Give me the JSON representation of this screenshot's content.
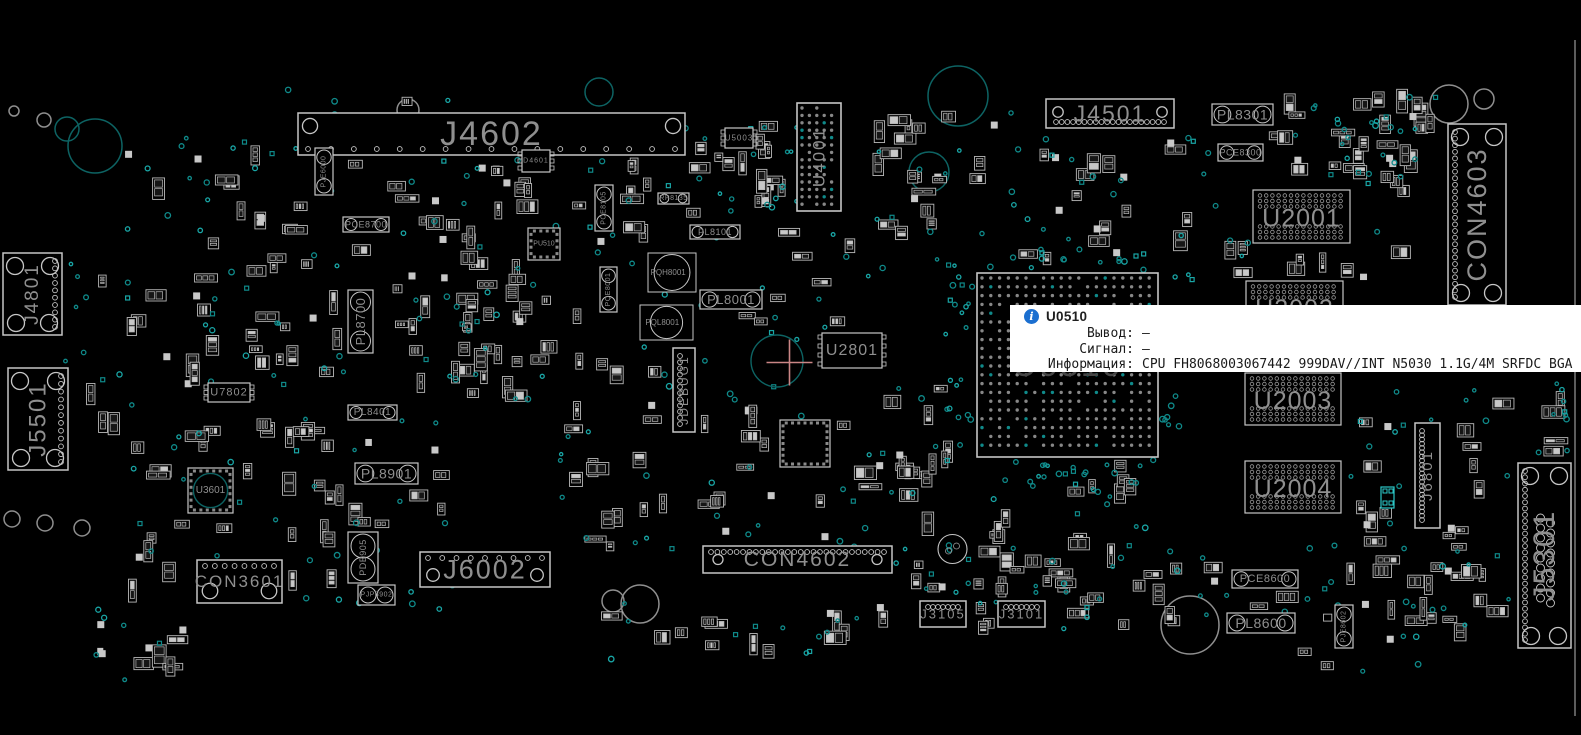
{
  "app": {
    "name": "boardview",
    "view": "top"
  },
  "tooltip": {
    "title": "U0510",
    "icon": "info-icon",
    "accent_color": "#1b6fd0",
    "rows": [
      {
        "label": "Вывод:",
        "value": "—"
      },
      {
        "label": "Сигнал:",
        "value": "—"
      },
      {
        "label": "Информация:",
        "value": "CPU FH8068003067442 999DAV//INT N5030 1.1G/4M SRFDC BGA"
      }
    ]
  },
  "board": {
    "colors": {
      "background": "#000000",
      "outline": "#c6c6c6",
      "outline_dim": "#9a9a9a",
      "label": "#8f8f8f",
      "label_dim": "#454545",
      "pad_dark": "#161616",
      "pad_bright": "#c8c8c8",
      "via": "#0f8a8a",
      "via_bright": "#19a6a6",
      "hole_teal": "#0d6363",
      "hole_gray": "#8f8f8f",
      "highlight": "#2cc8c8",
      "crosshair": "#ca8585",
      "edge": "#9a9a9a"
    },
    "components": [
      {
        "label": "J4602",
        "x": 298,
        "y": 113,
        "w": 387,
        "h": 42,
        "type": "con",
        "fs": 34,
        "orient": "h",
        "pins": "bottom:17",
        "corners": "tl,tr"
      },
      {
        "label": "J4501",
        "x": 1046,
        "y": 99,
        "w": 128,
        "h": 29,
        "type": "con",
        "fs": 23,
        "orient": "h",
        "pins": "bottom:20",
        "corners": "tl,tr"
      },
      {
        "label": "CON4603",
        "x": 1448,
        "y": 124,
        "w": 58,
        "h": 181,
        "type": "con",
        "fs": 27,
        "orient": "v",
        "pins": "left:26",
        "corners": "all"
      },
      {
        "label": "U4001",
        "x": 797,
        "y": 103,
        "w": 44,
        "h": 108,
        "type": "bga",
        "fs": 17,
        "orient": "v",
        "grid": 7.4
      },
      {
        "label": "U2001",
        "x": 1253,
        "y": 190,
        "w": 97,
        "h": 53,
        "type": "mem",
        "fs": 25,
        "orient": "h"
      },
      {
        "label": "U2002",
        "x": 1246,
        "y": 281,
        "w": 97,
        "h": 52,
        "type": "mem",
        "fs": 25,
        "orient": "h"
      },
      {
        "label": "U2003",
        "x": 1245,
        "y": 373,
        "w": 96,
        "h": 52,
        "type": "mem",
        "fs": 25,
        "orient": "h"
      },
      {
        "label": "U2004",
        "x": 1245,
        "y": 461,
        "w": 96,
        "h": 52,
        "type": "mem",
        "fs": 25,
        "orient": "h"
      },
      {
        "label": "U0510",
        "x": 977,
        "y": 273,
        "w": 181,
        "h": 184,
        "type": "bga",
        "fs": 34,
        "orient": "h",
        "grid": 8.8,
        "dim": true
      },
      {
        "label": "J6801",
        "x": 1415,
        "y": 423,
        "w": 25,
        "h": 105,
        "type": "con",
        "fs": 15,
        "orient": "v",
        "pins": "left:22",
        "corners": "none"
      },
      {
        "label": "J5301",
        "x": 1518,
        "y": 463,
        "w": 53,
        "h": 185,
        "type": "con",
        "fs": 30,
        "orient": "v",
        "pins": "left:28",
        "corners": "all",
        "extra": "midcircles"
      },
      {
        "label": "J4801",
        "x": 3,
        "y": 253,
        "w": 59,
        "h": 82,
        "type": "con",
        "fs": 19,
        "orient": "v",
        "pins": "right:10",
        "corners": "all"
      },
      {
        "label": "J5501",
        "x": 8,
        "y": 368,
        "w": 60,
        "h": 102,
        "type": "con",
        "fs": 24,
        "orient": "v",
        "pins": "right:12",
        "corners": "all"
      },
      {
        "label": "CON3601",
        "x": 197,
        "y": 560,
        "w": 85,
        "h": 43,
        "type": "con",
        "fs": 17,
        "orient": "h",
        "pins": "top:8",
        "corners": "bl,br"
      },
      {
        "label": "J6002",
        "x": 420,
        "y": 552,
        "w": 130,
        "h": 35,
        "type": "con",
        "fs": 27,
        "orient": "h",
        "pins": "top:9",
        "corners": "bl,br"
      },
      {
        "label": "CON4602",
        "x": 703,
        "y": 546,
        "w": 189,
        "h": 27,
        "type": "con",
        "fs": 21,
        "orient": "h",
        "pins": "top:28",
        "corners": "lr"
      },
      {
        "label": "J3105",
        "x": 920,
        "y": 601,
        "w": 46,
        "h": 26,
        "type": "con",
        "fs": 13,
        "orient": "h",
        "pins": "top:7",
        "corners": "none"
      },
      {
        "label": "J3101",
        "x": 998,
        "y": 601,
        "w": 47,
        "h": 26,
        "type": "con",
        "fs": 13,
        "orient": "h",
        "pins": "top:7",
        "corners": "none"
      },
      {
        "label": "JDEBUG1",
        "x": 673,
        "y": 348,
        "w": 22,
        "h": 84,
        "type": "con",
        "fs": 12,
        "orient": "v",
        "pins": "left:12",
        "corners": "none"
      },
      {
        "label": "U2801",
        "x": 822,
        "y": 333,
        "w": 60,
        "h": 35,
        "type": "chip",
        "fs": 16,
        "pins": "lr:4"
      },
      {
        "label": "U3601",
        "x": 188,
        "y": 468,
        "w": 45,
        "h": 45,
        "type": "qfn",
        "fs": 10,
        "circle": true
      },
      {
        "label": "U7802",
        "x": 208,
        "y": 383,
        "w": 42,
        "h": 19,
        "type": "chip",
        "fs": 11,
        "pins": "lr:3"
      },
      {
        "label": "U5003",
        "x": 725,
        "y": 128,
        "w": 28,
        "h": 20,
        "type": "chip",
        "fs": 8,
        "pins": "lr:3"
      },
      {
        "label": "D4601",
        "x": 522,
        "y": 150,
        "w": 28,
        "h": 22,
        "type": "chip",
        "fs": 7,
        "pins": "lr:3"
      },
      {
        "label": "PU510",
        "x": 528,
        "y": 228,
        "w": 32,
        "h": 32,
        "type": "qfn",
        "fs": 7
      },
      {
        "label": "",
        "x": 780,
        "y": 420,
        "w": 50,
        "h": 47,
        "type": "qfn",
        "fs": 0
      },
      {
        "label": "PL8301",
        "x": 1212,
        "y": 104,
        "w": 61,
        "h": 21,
        "type": "pill",
        "fs": 14
      },
      {
        "label": "PCE8300",
        "x": 1218,
        "y": 144,
        "w": 45,
        "h": 17,
        "type": "pill",
        "fs": 9
      },
      {
        "label": "PL8901",
        "x": 355,
        "y": 463,
        "w": 63,
        "h": 21,
        "type": "pill",
        "fs": 14
      },
      {
        "label": "PL8600",
        "x": 1227,
        "y": 613,
        "w": 68,
        "h": 20,
        "type": "pill",
        "fs": 14
      },
      {
        "label": "PCE8600",
        "x": 1232,
        "y": 570,
        "w": 66,
        "h": 18,
        "type": "pill",
        "fs": 11
      },
      {
        "label": "PL8001",
        "x": 700,
        "y": 290,
        "w": 62,
        "h": 19,
        "type": "pill",
        "fs": 13
      },
      {
        "label": "PL8101",
        "x": 690,
        "y": 225,
        "w": 50,
        "h": 14,
        "type": "pill",
        "fs": 9
      },
      {
        "label": "PL8401",
        "x": 348,
        "y": 405,
        "w": 49,
        "h": 15,
        "type": "pill",
        "fs": 10
      },
      {
        "label": "PCE8700",
        "x": 343,
        "y": 217,
        "w": 46,
        "h": 15,
        "type": "pill",
        "fs": 9
      },
      {
        "label": "PL8700",
        "x": 348,
        "y": 290,
        "w": 25,
        "h": 63,
        "type": "pill",
        "fs": 13,
        "orient": "v"
      },
      {
        "label": "PCE8105",
        "x": 595,
        "y": 185,
        "w": 18,
        "h": 46,
        "type": "pill",
        "fs": 7,
        "orient": "v"
      },
      {
        "label": "PJE6000",
        "x": 315,
        "y": 148,
        "w": 18,
        "h": 47,
        "type": "pill",
        "fs": 7,
        "orient": "v"
      },
      {
        "label": "PQE8001",
        "x": 600,
        "y": 267,
        "w": 17,
        "h": 45,
        "type": "pill",
        "fs": 7,
        "orient": "v"
      },
      {
        "label": "PDB905",
        "x": 348,
        "y": 532,
        "w": 30,
        "h": 51,
        "type": "pill",
        "fs": 9,
        "orient": "v"
      },
      {
        "label": "PJE8602",
        "x": 1335,
        "y": 605,
        "w": 18,
        "h": 43,
        "type": "pill",
        "fs": 7,
        "orient": "v"
      },
      {
        "label": "PJP8902",
        "x": 358,
        "y": 585,
        "w": 37,
        "h": 20,
        "type": "pill",
        "fs": 7
      },
      {
        "label": "RP8135",
        "x": 658,
        "y": 193,
        "w": 31,
        "h": 11,
        "type": "pill",
        "fs": 7
      },
      {
        "label": "PQH8001",
        "x": 648,
        "y": 253,
        "w": 48,
        "h": 39,
        "type": "coil",
        "fs": 8
      },
      {
        "label": "PQL8001",
        "x": 640,
        "y": 305,
        "w": 53,
        "h": 35,
        "type": "coil",
        "fs": 8
      },
      {
        "label": "",
        "x": 938,
        "y": 535,
        "w": 29,
        "h": 28,
        "type": "round",
        "fs": 0
      }
    ],
    "highlighted_component": {
      "x": 1381,
      "y": 487,
      "w": 13,
      "h": 21
    },
    "crosshair": {
      "cx": 777,
      "cy": 361,
      "r": 26,
      "lx": 789.5,
      "ly": 362.5,
      "arm": 23
    },
    "edge_line": {
      "x": 1575,
      "y1": 40,
      "y2": 716
    },
    "holes": [
      [
        958,
        96,
        30,
        "t"
      ],
      [
        929,
        172,
        20,
        "t"
      ],
      [
        599,
        92,
        14,
        "t"
      ],
      [
        408,
        110,
        11,
        "g"
      ],
      [
        95,
        146,
        27,
        "t"
      ],
      [
        67,
        129,
        12,
        "t"
      ],
      [
        44,
        120,
        7,
        "g"
      ],
      [
        14,
        111,
        5,
        "g"
      ],
      [
        1449,
        104,
        19,
        "g"
      ],
      [
        1484,
        99,
        10,
        "g"
      ],
      [
        1190,
        625,
        29,
        "g"
      ],
      [
        640,
        604,
        19,
        "g"
      ],
      [
        613,
        601,
        11,
        "g"
      ],
      [
        12,
        519,
        8,
        "g"
      ],
      [
        45,
        523,
        8,
        "g"
      ],
      [
        82,
        528,
        8,
        "g"
      ]
    ],
    "filler_regions": [
      {
        "x": 125,
        "y": 135,
        "w": 410,
        "h": 275,
        "n": 90,
        "v": 55
      },
      {
        "x": 125,
        "y": 415,
        "w": 330,
        "h": 195,
        "n": 60,
        "v": 35
      },
      {
        "x": 445,
        "y": 125,
        "w": 410,
        "h": 260,
        "n": 80,
        "v": 50
      },
      {
        "x": 560,
        "y": 385,
        "w": 400,
        "h": 170,
        "n": 50,
        "v": 35
      },
      {
        "x": 865,
        "y": 110,
        "w": 270,
        "h": 170,
        "n": 38,
        "v": 30
      },
      {
        "x": 870,
        "y": 445,
        "w": 290,
        "h": 150,
        "n": 38,
        "v": 30
      },
      {
        "x": 1155,
        "y": 120,
        "w": 270,
        "h": 165,
        "n": 36,
        "v": 28
      },
      {
        "x": 1345,
        "y": 390,
        "w": 215,
        "h": 245,
        "n": 38,
        "v": 26
      },
      {
        "x": 1200,
        "y": 545,
        "w": 350,
        "h": 130,
        "n": 30,
        "v": 22
      },
      {
        "x": 955,
        "y": 545,
        "w": 230,
        "h": 90,
        "n": 22,
        "v": 16
      },
      {
        "x": 270,
        "y": 88,
        "w": 230,
        "h": 50,
        "n": 12,
        "v": 8
      },
      {
        "x": 700,
        "y": 118,
        "w": 150,
        "h": 120,
        "n": 18,
        "v": 14
      },
      {
        "x": 1270,
        "y": 88,
        "w": 170,
        "h": 95,
        "n": 20,
        "v": 14
      },
      {
        "x": 945,
        "y": 262,
        "w": 28,
        "h": 200,
        "n": 0,
        "v": 22
      },
      {
        "x": 1150,
        "y": 280,
        "w": 30,
        "h": 180,
        "n": 0,
        "v": 18
      },
      {
        "x": 985,
        "y": 250,
        "w": 160,
        "h": 20,
        "n": 0,
        "v": 14
      },
      {
        "x": 985,
        "y": 458,
        "w": 160,
        "h": 25,
        "n": 0,
        "v": 16
      },
      {
        "x": 60,
        "y": 240,
        "w": 60,
        "h": 230,
        "n": 6,
        "v": 10
      },
      {
        "x": 1540,
        "y": 380,
        "w": 28,
        "h": 250,
        "n": 8,
        "v": 10
      },
      {
        "x": 600,
        "y": 600,
        "w": 330,
        "h": 60,
        "n": 14,
        "v": 12
      },
      {
        "x": 90,
        "y": 600,
        "w": 100,
        "h": 80,
        "n": 10,
        "v": 6
      }
    ]
  }
}
